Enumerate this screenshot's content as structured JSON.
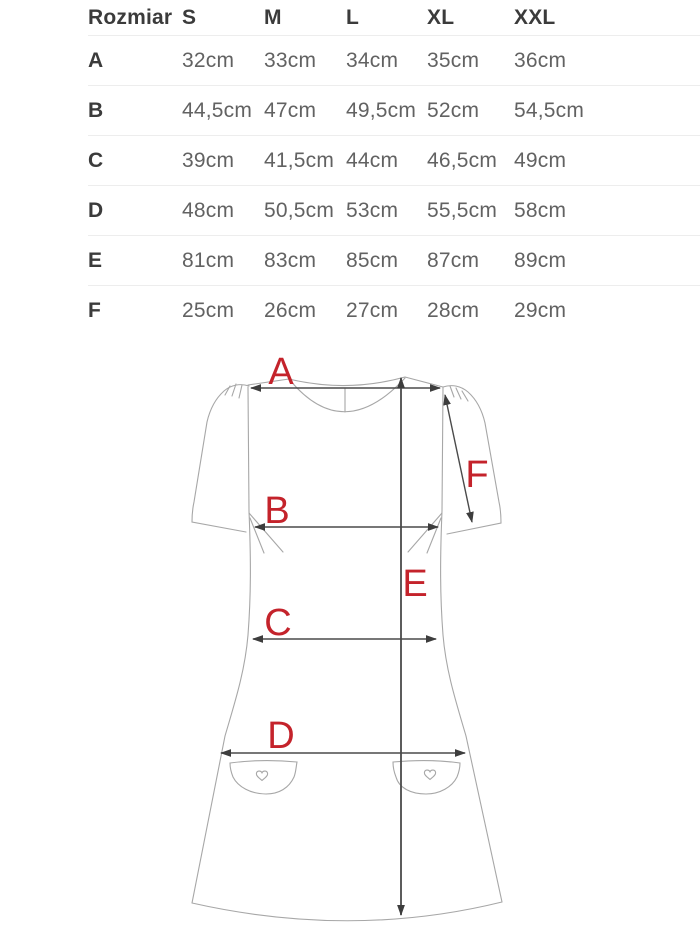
{
  "size_table": {
    "header_label": "Rozmiar",
    "columns": [
      "S",
      "M",
      "L",
      "XL",
      "XXL"
    ],
    "rows": [
      {
        "label": "A",
        "values": [
          "32cm",
          "33cm",
          "34cm",
          "35cm",
          "36cm"
        ]
      },
      {
        "label": "B",
        "values": [
          "44,5cm",
          "47cm",
          "49,5cm",
          "52cm",
          "54,5cm"
        ]
      },
      {
        "label": "C",
        "values": [
          "39cm",
          "41,5cm",
          "44cm",
          "46,5cm",
          "49cm"
        ]
      },
      {
        "label": "D",
        "values": [
          "48cm",
          "50,5cm",
          "53cm",
          "55,5cm",
          "58cm"
        ]
      },
      {
        "label": "E",
        "values": [
          "81cm",
          "83cm",
          "85cm",
          "87cm",
          "89cm"
        ]
      },
      {
        "label": "F",
        "values": [
          "25cm",
          "26cm",
          "27cm",
          "28cm",
          "29cm"
        ]
      }
    ]
  },
  "diagram": {
    "measurements": {
      "a": "A",
      "b": "B",
      "c": "C",
      "d": "D",
      "e": "E",
      "f": "F"
    },
    "label_color": "#c4232b",
    "outline_color": "#a7a7a7",
    "arrow_color": "#4a4a4a",
    "pocket_icon": "heart-icon"
  }
}
